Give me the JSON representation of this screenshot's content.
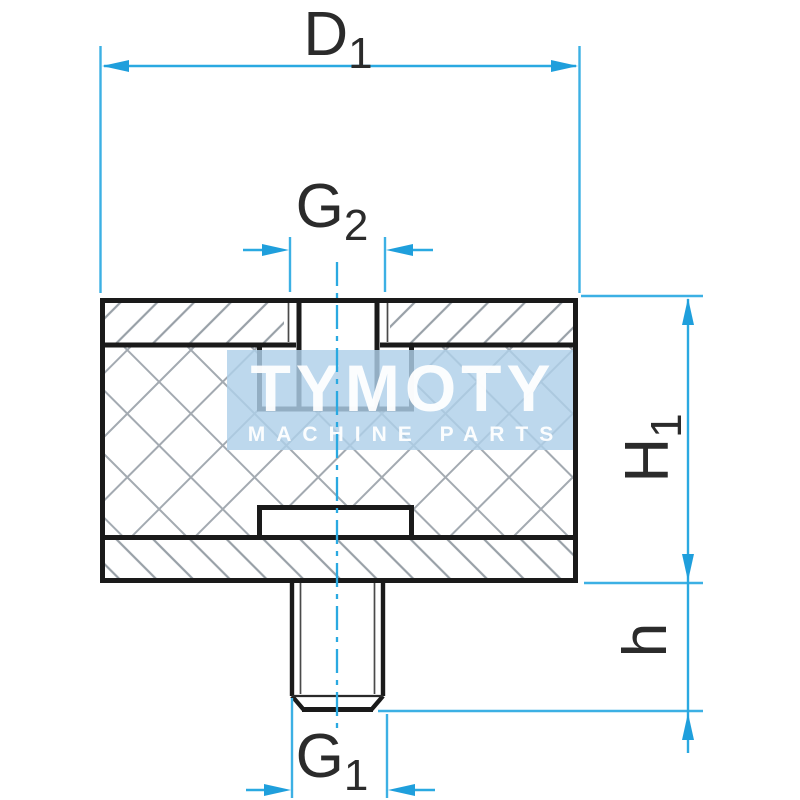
{
  "figure": {
    "description": "Technical cross-section drawing of rubber-metal buffer mount with internal thread on top and threaded stud on bottom",
    "watermark": {
      "brand": "TYMOTY",
      "tagline": "MACHINE PARTS"
    },
    "dimensions": {
      "top_width": {
        "main": "D",
        "sub": "1"
      },
      "thread_top": {
        "main": "G",
        "sub": "2"
      },
      "body_height": {
        "main": "H",
        "sub": "1"
      },
      "stud_height": {
        "main": "h",
        "sub": ""
      },
      "thread_bottom": {
        "main": "G",
        "sub": "1"
      }
    },
    "colors": {
      "dimension_line": "#2aa9e1",
      "part_outline": "#1a1a1a",
      "hatch_line": "#9aa1a8",
      "watermark_bg": "#aecfe9",
      "watermark_text": "#ffffff"
    }
  }
}
